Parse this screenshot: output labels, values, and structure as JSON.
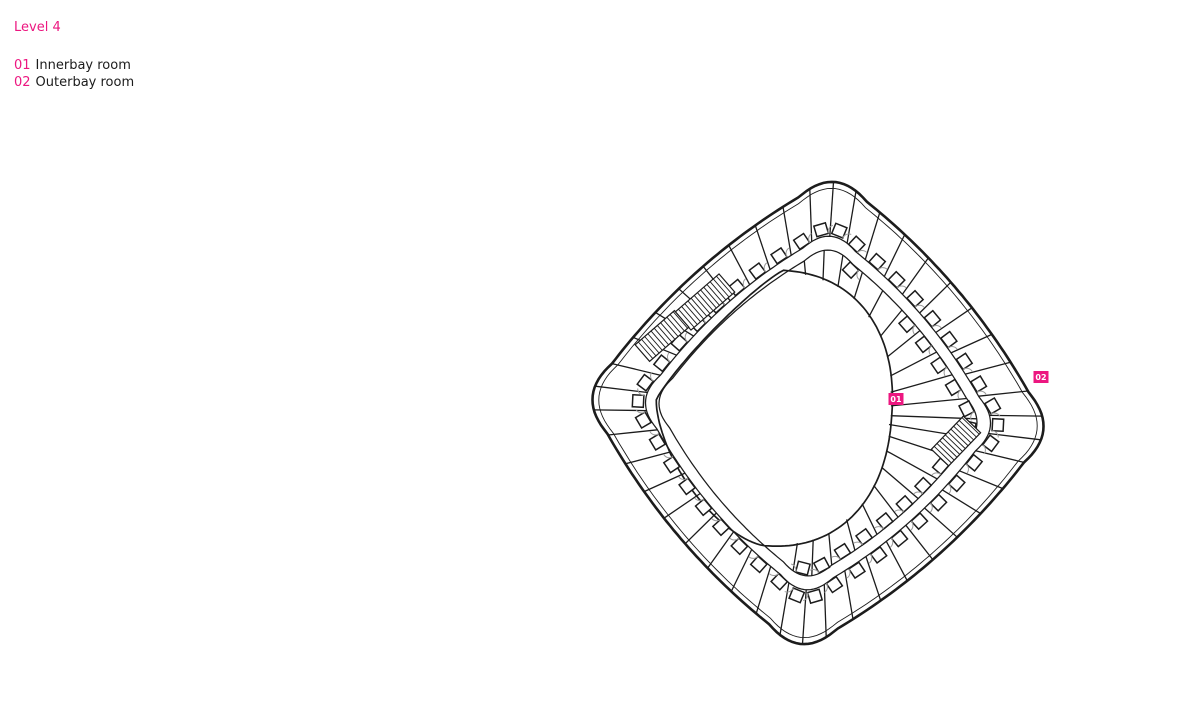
{
  "title": "Level 4",
  "legend": {
    "items": [
      {
        "num": "01",
        "label": "Innerbay room"
      },
      {
        "num": "02",
        "label": "Outerbay room"
      }
    ]
  },
  "plan": {
    "labels": [
      {
        "text": "01",
        "x": 896,
        "y": 399
      },
      {
        "text": "02",
        "x": 1041,
        "y": 377
      }
    ]
  },
  "colors": {
    "accent": "#ec1780",
    "ink": "#1c1c1c",
    "door_arc": "#9b9b9b",
    "label_text": "#ffffff",
    "background": "#ffffff"
  }
}
